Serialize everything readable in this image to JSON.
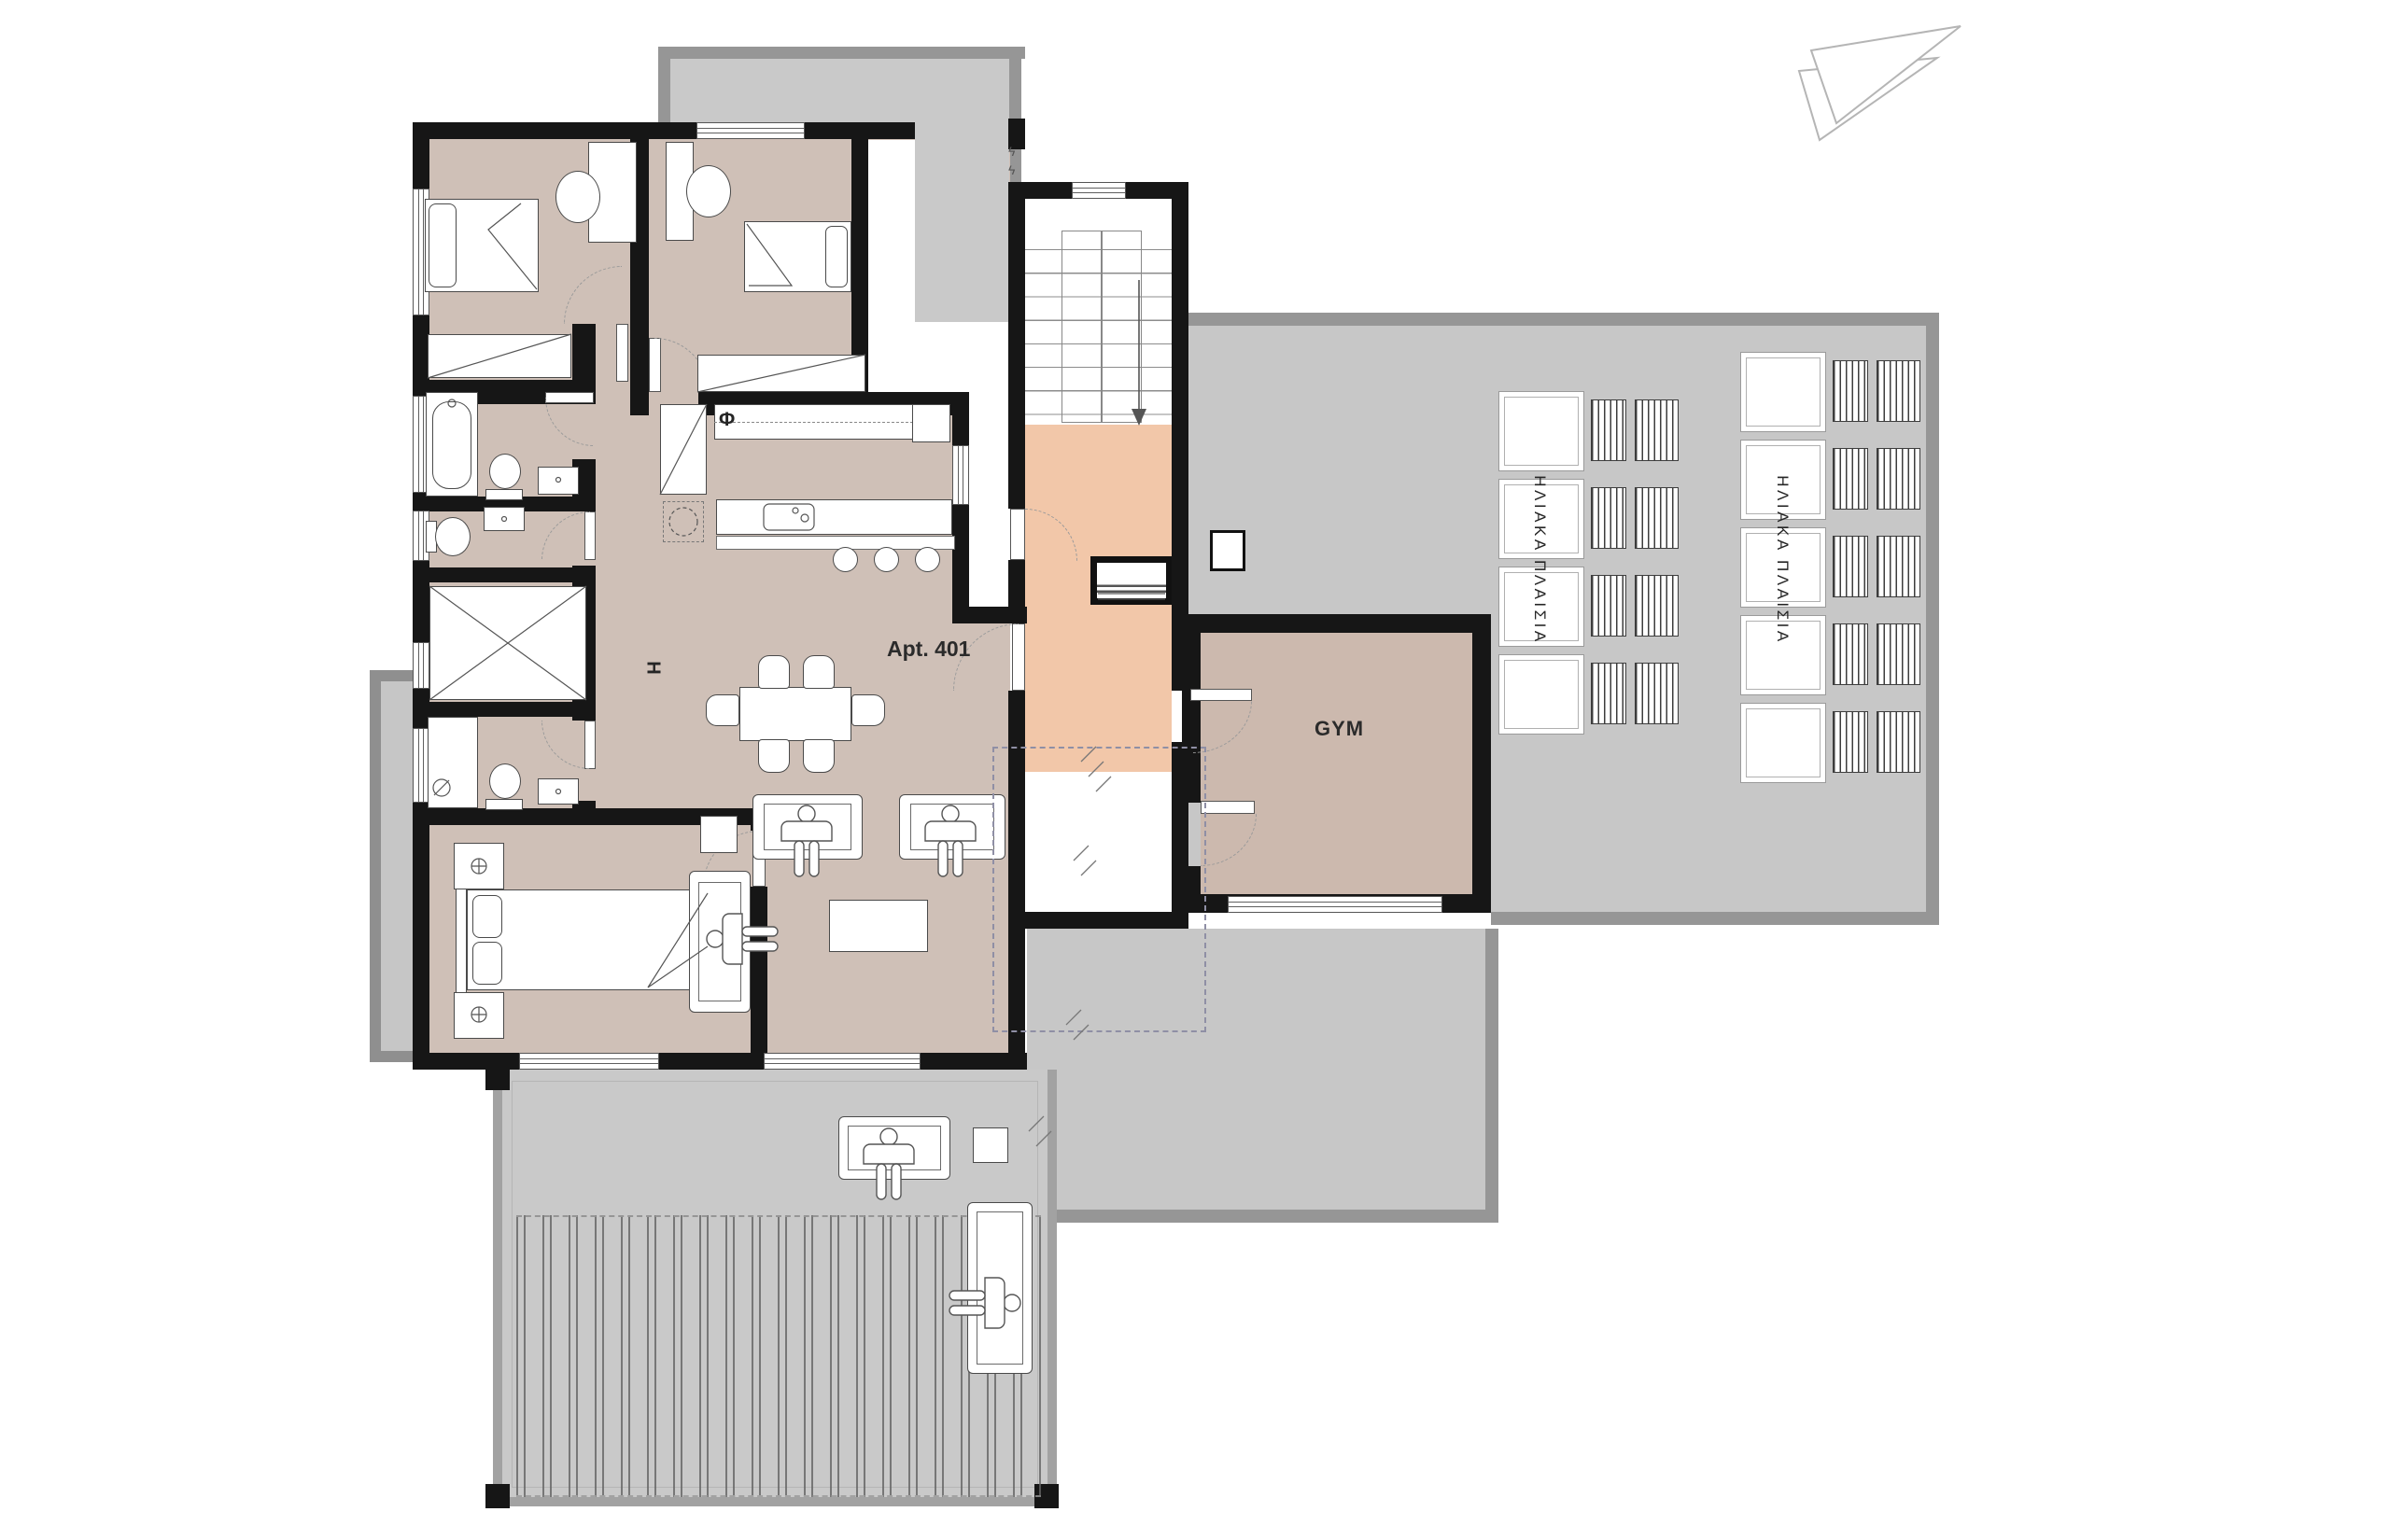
{
  "labels": {
    "apartment": "Apt. 401",
    "gym": "GYM",
    "section_marker": "H",
    "kitchen_symbol": "Φ",
    "elec_mark": "ϟ"
  },
  "solar_groups": [
    {
      "label": "ΗΛΙΑΚΑ  ΠΛΑΙΣΙΑ",
      "rows": 4
    },
    {
      "label": "ΗΛΙΑΚΑ  ΠΛΑΙΣΙΑ",
      "rows": 5
    }
  ],
  "colors": {
    "wall": "#161616",
    "apartment_floor": "#cfc0b7",
    "gym_floor": "#ccb9ae",
    "landing_floor": "#f2c7a9",
    "roof": "#c7c7c7",
    "roof_border": "#969696",
    "terrace": "#c9c9c9"
  }
}
